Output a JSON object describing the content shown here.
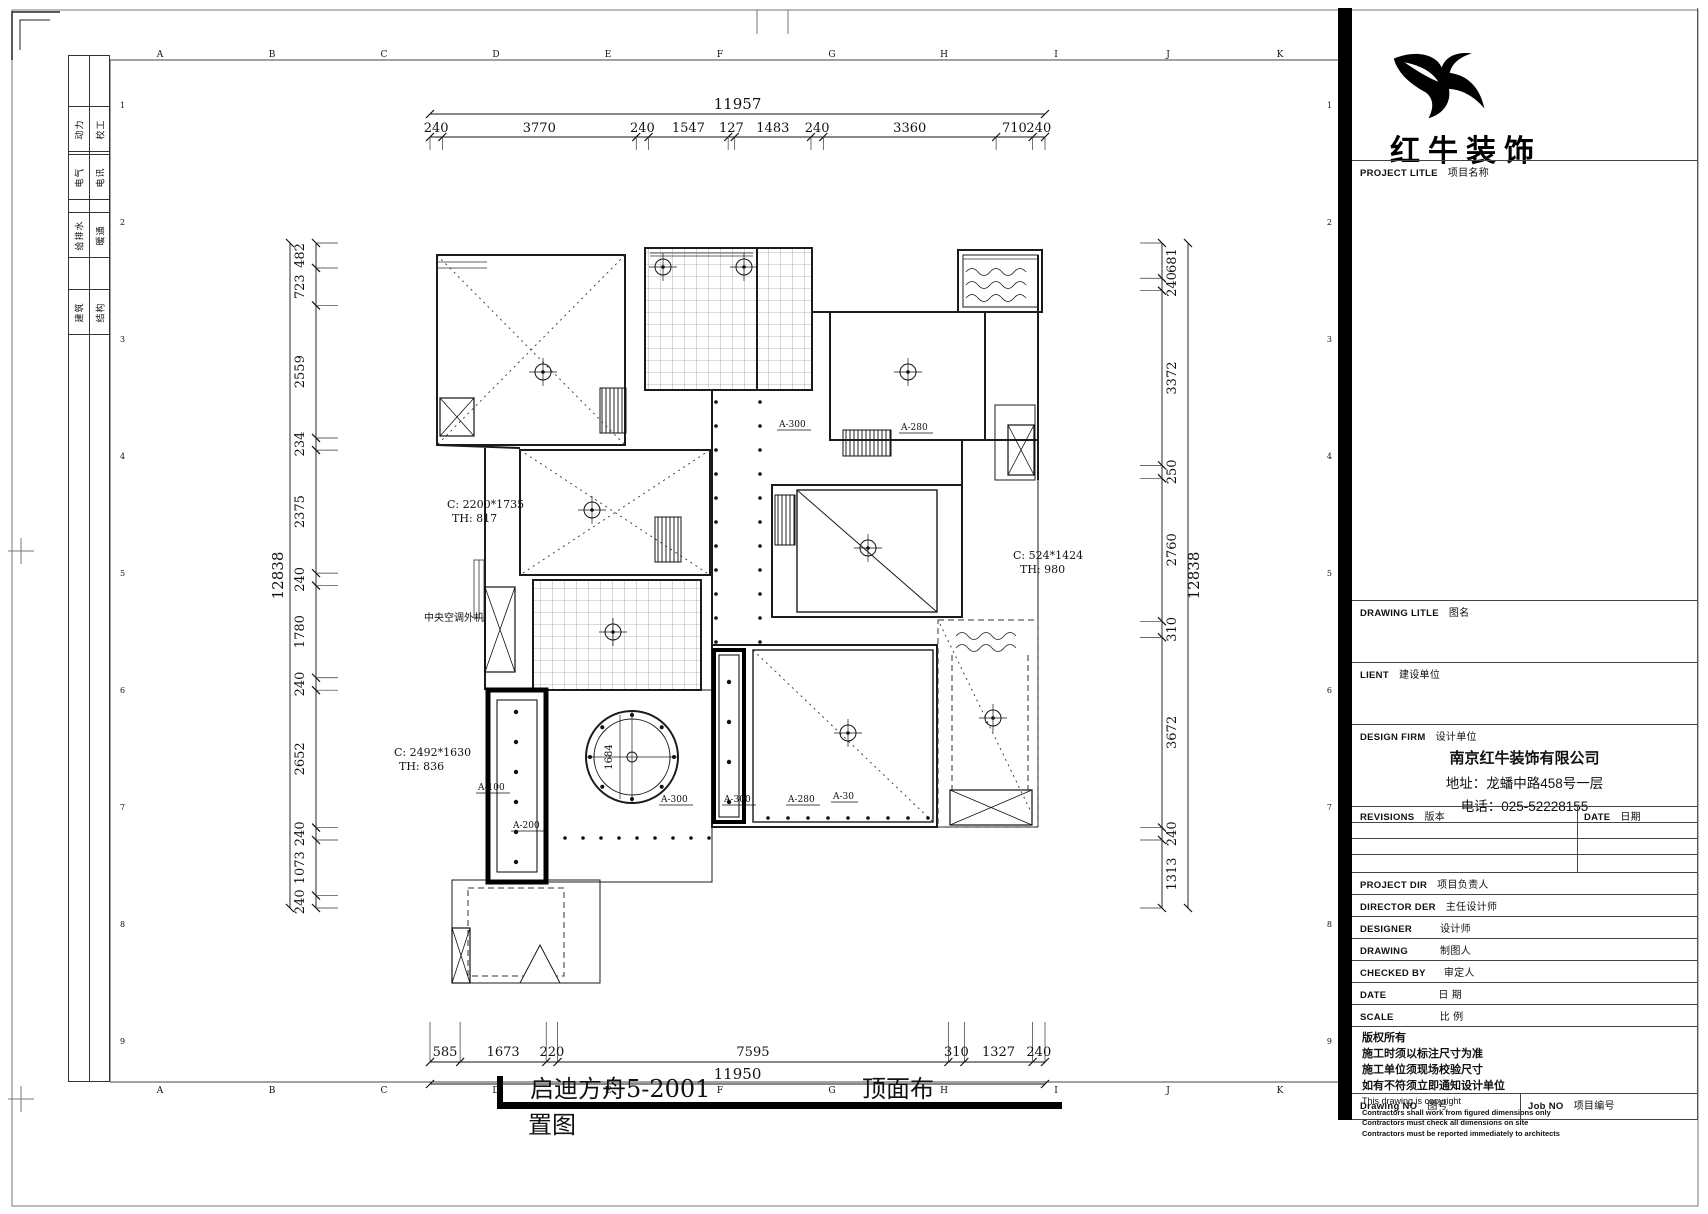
{
  "sheet": {
    "grid_letters": [
      "A",
      "B",
      "C",
      "D",
      "E",
      "F",
      "G",
      "H",
      "I",
      "J",
      "K"
    ],
    "grid_numbers": [
      "1",
      "2",
      "3",
      "4",
      "5",
      "6",
      "7",
      "8",
      "9"
    ],
    "disciplines": [
      {
        "a": "动力",
        "b": "校工"
      },
      {
        "a": "电气",
        "b": "电讯"
      },
      {
        "a": "给排水",
        "b": "暖通"
      },
      {
        "a": "建筑",
        "b": "结构"
      }
    ]
  },
  "plan": {
    "dim_top": {
      "total": "11957",
      "segments": [
        "240",
        "3770",
        "240",
        "1547",
        "127",
        "1483",
        "240",
        "3360",
        "710",
        "240"
      ]
    },
    "dim_bottom": {
      "total": "11950",
      "segments": [
        "585",
        "1673",
        "220",
        "7595",
        "310",
        "1327",
        "240"
      ]
    },
    "dim_left": {
      "total": "12838",
      "segments": [
        "482",
        "723",
        "2559",
        "234",
        "2375",
        "240",
        "1780",
        "240",
        "2652",
        "240",
        "1073",
        "240"
      ]
    },
    "dim_right": {
      "total": "12838",
      "segments": [
        "681",
        "240",
        "3372",
        "250",
        "2760",
        "310",
        "3672",
        "240",
        "1313"
      ]
    },
    "annotations": {
      "c1": "C: 2200*1735",
      "c1b": "TH: 817",
      "c2": "C: 2492*1630",
      "c2b": "TH: 836",
      "c3": "C: 524*1424",
      "c3b": "TH: 980",
      "ac": "中央空调外机",
      "a300_top": "A-300",
      "a280_top": "A-280",
      "a100": "A-100",
      "a200": "A-200",
      "a300_mid": "A-300",
      "a300_low": "A-300",
      "a280_low": "A-280",
      "a30": "A-30",
      "circle_dim": "1684"
    },
    "title": {
      "part1": "启迪方舟5-2001",
      "part2": "顶面布",
      "part3": "置图"
    }
  },
  "titleblock": {
    "brand": "红牛装饰",
    "project": {
      "en": "PROJECT LITLE",
      "cn": "项目名称"
    },
    "drawing_title": {
      "en": "DRAWING LITLE",
      "cn": "图名"
    },
    "client": {
      "en": "LIENT",
      "cn": "建设单位"
    },
    "design_firm": {
      "en": "DESIGN FIRM",
      "cn": "设计单位"
    },
    "revisions": {
      "en": "REVISIONS",
      "cn": "版本"
    },
    "rev_date": {
      "en": "DATE",
      "cn": "日期"
    },
    "project_dir": {
      "en": "PROJECT DIR",
      "cn": "项目负责人"
    },
    "director": {
      "en": "DIRECTOR DER",
      "cn": "主任设计师"
    },
    "designer": {
      "en": "DESIGNER",
      "cn": "设计师"
    },
    "drawing_by": {
      "en": "DRAWING",
      "cn": "制图人"
    },
    "checked_by": {
      "en": "CHECKED BY",
      "cn": "审定人"
    },
    "date": {
      "en": "DATE",
      "cn": "日 期"
    },
    "scale": {
      "en": "SCALE",
      "cn": "比 例"
    },
    "drawing_no": {
      "en": "Drawing NO",
      "cn": "图号"
    },
    "job_no": {
      "en": "Job NO",
      "cn": "项目编号"
    },
    "company": {
      "name": "南京红牛装饰有限公司",
      "address": "地址：龙蟠中路458号一层",
      "phone": "电话：025-52228155"
    },
    "copyright": {
      "l1": "版权所有",
      "l2": "施工时须以标注尺寸为准",
      "l3": "施工单位须现场校验尺寸",
      "l4": "如有不符须立即通知设计单位",
      "l5": "This drawing is copyright",
      "l6": "Contractors shall work from figured dimensions only",
      "l7": "Contractors must check all dimensions on site",
      "l8": "Contractors must be reported immediately to architects"
    }
  }
}
